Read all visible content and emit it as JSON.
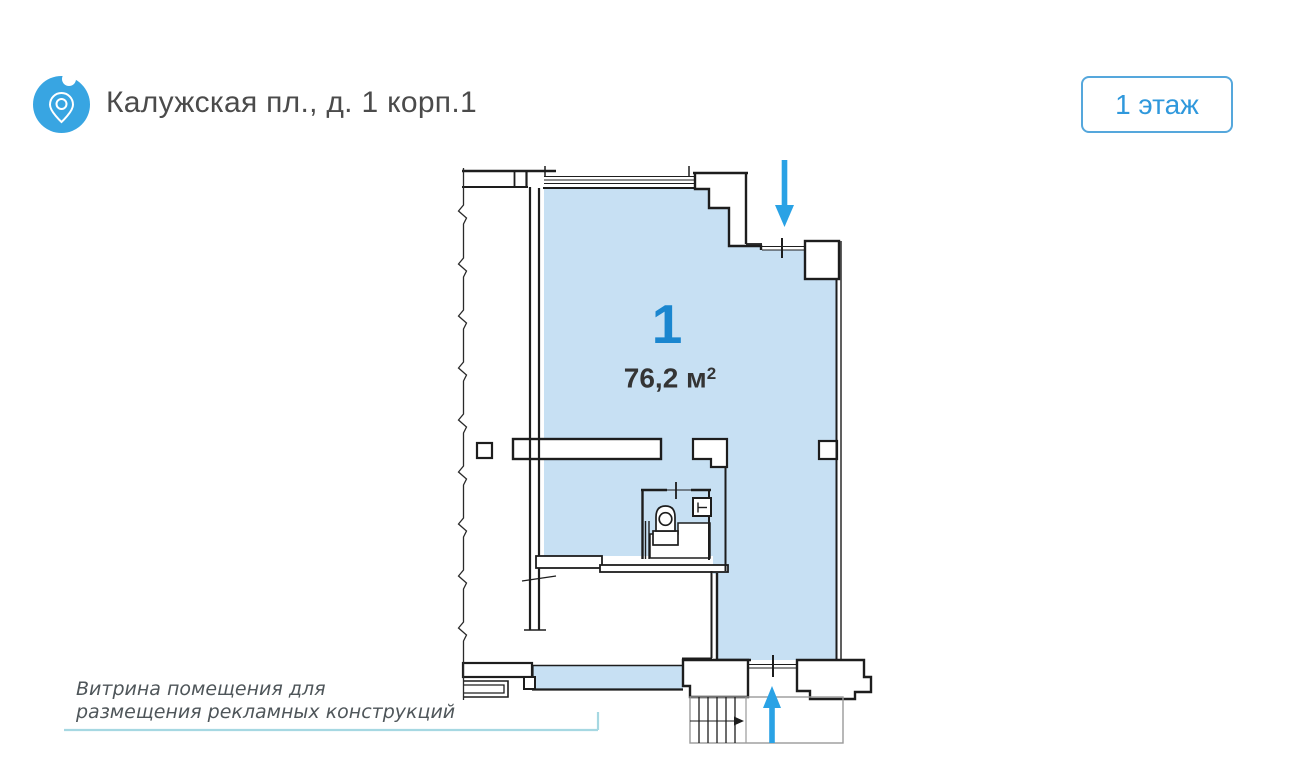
{
  "header": {
    "title": "Калужская пл., д. 1 корп.1",
    "floor_badge_label": "1 этаж"
  },
  "plan": {
    "room_number": "1",
    "area_value": "76,2 м",
    "area_superscript": "2",
    "annotation_line1": "Витрина помещения для",
    "annotation_line2": "размещения рекламных конструкций"
  },
  "icons": {
    "location": "location-pin-icon",
    "entrance_top": "arrow-down-icon",
    "entrance_bottom": "arrow-up-icon",
    "stairs_direction": "arrow-right-icon"
  },
  "colors": {
    "accent_blue": "#2aa2e5",
    "room_fill": "#c7e0f3",
    "wall": "#1d1d1d",
    "badge_border": "#55a7dc",
    "badge_text": "#2f98dc",
    "room_number_text": "#1a86cf",
    "leader_line": "#a6d8e2",
    "title_text": "#4b4b4b",
    "annotation_text": "#4f565a"
  }
}
